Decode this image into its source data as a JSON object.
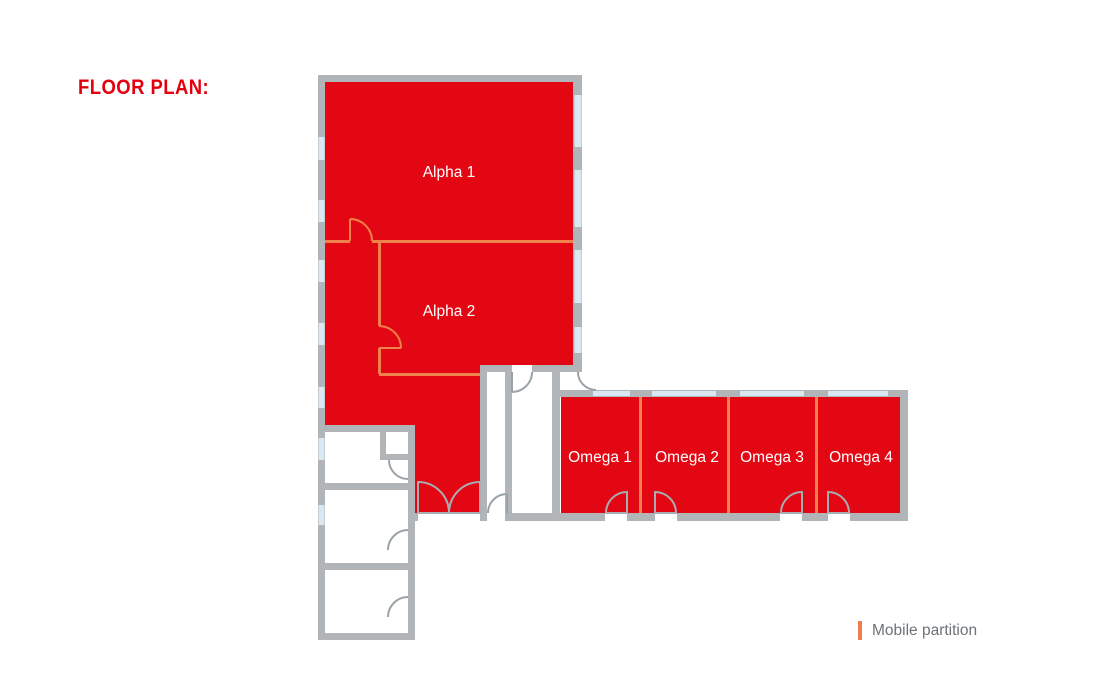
{
  "title": "FLOOR PLAN:",
  "rooms": {
    "alpha1": {
      "label": "Alpha 1"
    },
    "alpha2": {
      "label": "Alpha 2"
    },
    "omega1": {
      "label": "Omega 1"
    },
    "omega2": {
      "label": "Omega 2"
    },
    "omega3": {
      "label": "Omega 3"
    },
    "omega4": {
      "label": "Omega 4"
    }
  },
  "legend": {
    "label": "Mobile partition",
    "marker_color": "#ee7f4d"
  },
  "colors": {
    "room_fill": "#e30613",
    "mobile_partition": "#f0814d",
    "wall": "#b1b5b8",
    "window": "#d9e8f1",
    "room_label_text": "#ffffff",
    "title_text": "#e3000f",
    "legend_text": "#6d7278",
    "background": "#ffffff"
  }
}
